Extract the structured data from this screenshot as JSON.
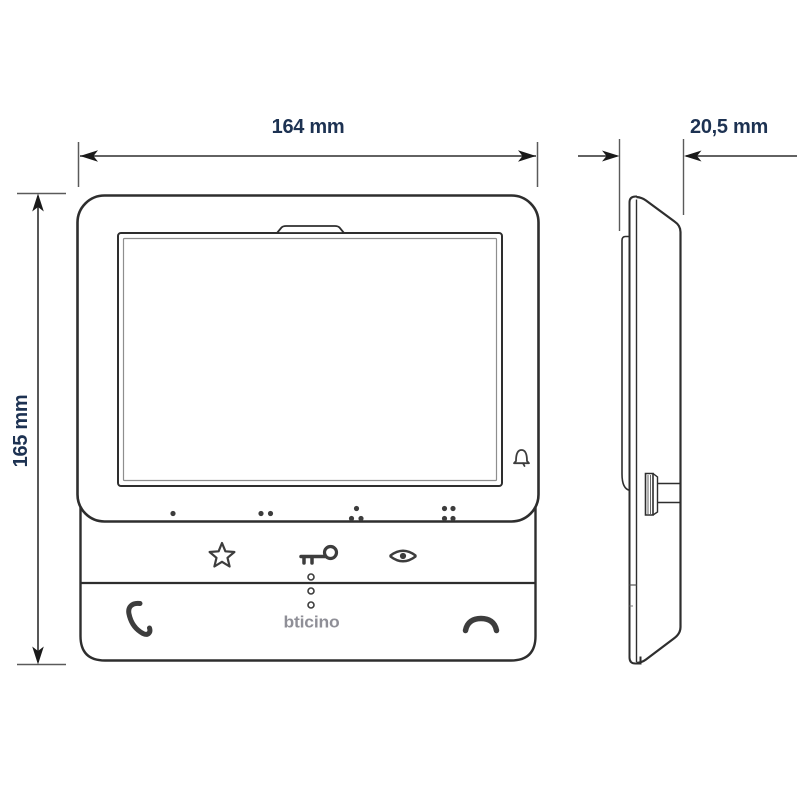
{
  "drawing": {
    "dimensions": {
      "width_label": "164 mm",
      "height_label": "165 mm",
      "depth_label": "20,5 mm"
    },
    "brand_logo": "bticino",
    "tactile_dot_groups": [
      1,
      2,
      3,
      4
    ],
    "colors": {
      "background": "#ffffff",
      "outline": "#2e2e2e",
      "extension_line": "#5a5a5a",
      "dimension_text": "#1d3252",
      "icon": "#3d3d3d",
      "logo_gray": "#8f8f97"
    },
    "icons": [
      "bell-icon",
      "star-icon",
      "key-icon",
      "eye-icon",
      "phone-answer-icon",
      "phone-hangup-icon"
    ]
  }
}
